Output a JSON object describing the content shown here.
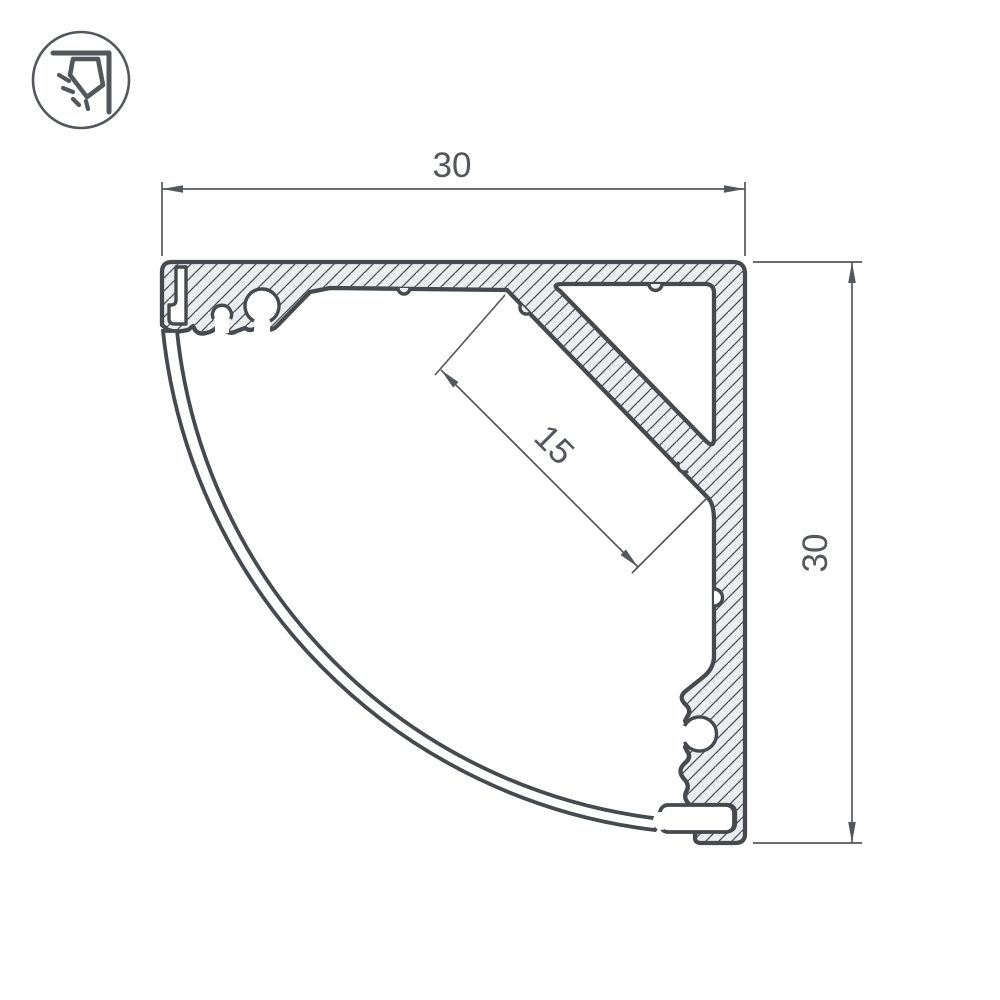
{
  "page": {
    "background": "#ffffff"
  },
  "logo": {
    "icon": "corner-lamp-icon",
    "shape": "circle-badge"
  },
  "drawing": {
    "type": "technical-cross-section-corner-led-profile",
    "dimensions": {
      "top_width": "30",
      "right_height": "30",
      "led_platform_width": "15"
    },
    "colors": {
      "outline": "#46494d",
      "aluminum_fill": "#ecedee",
      "dimension_line": "#54575c",
      "text": "#53565b",
      "background": "#ffffff"
    }
  }
}
